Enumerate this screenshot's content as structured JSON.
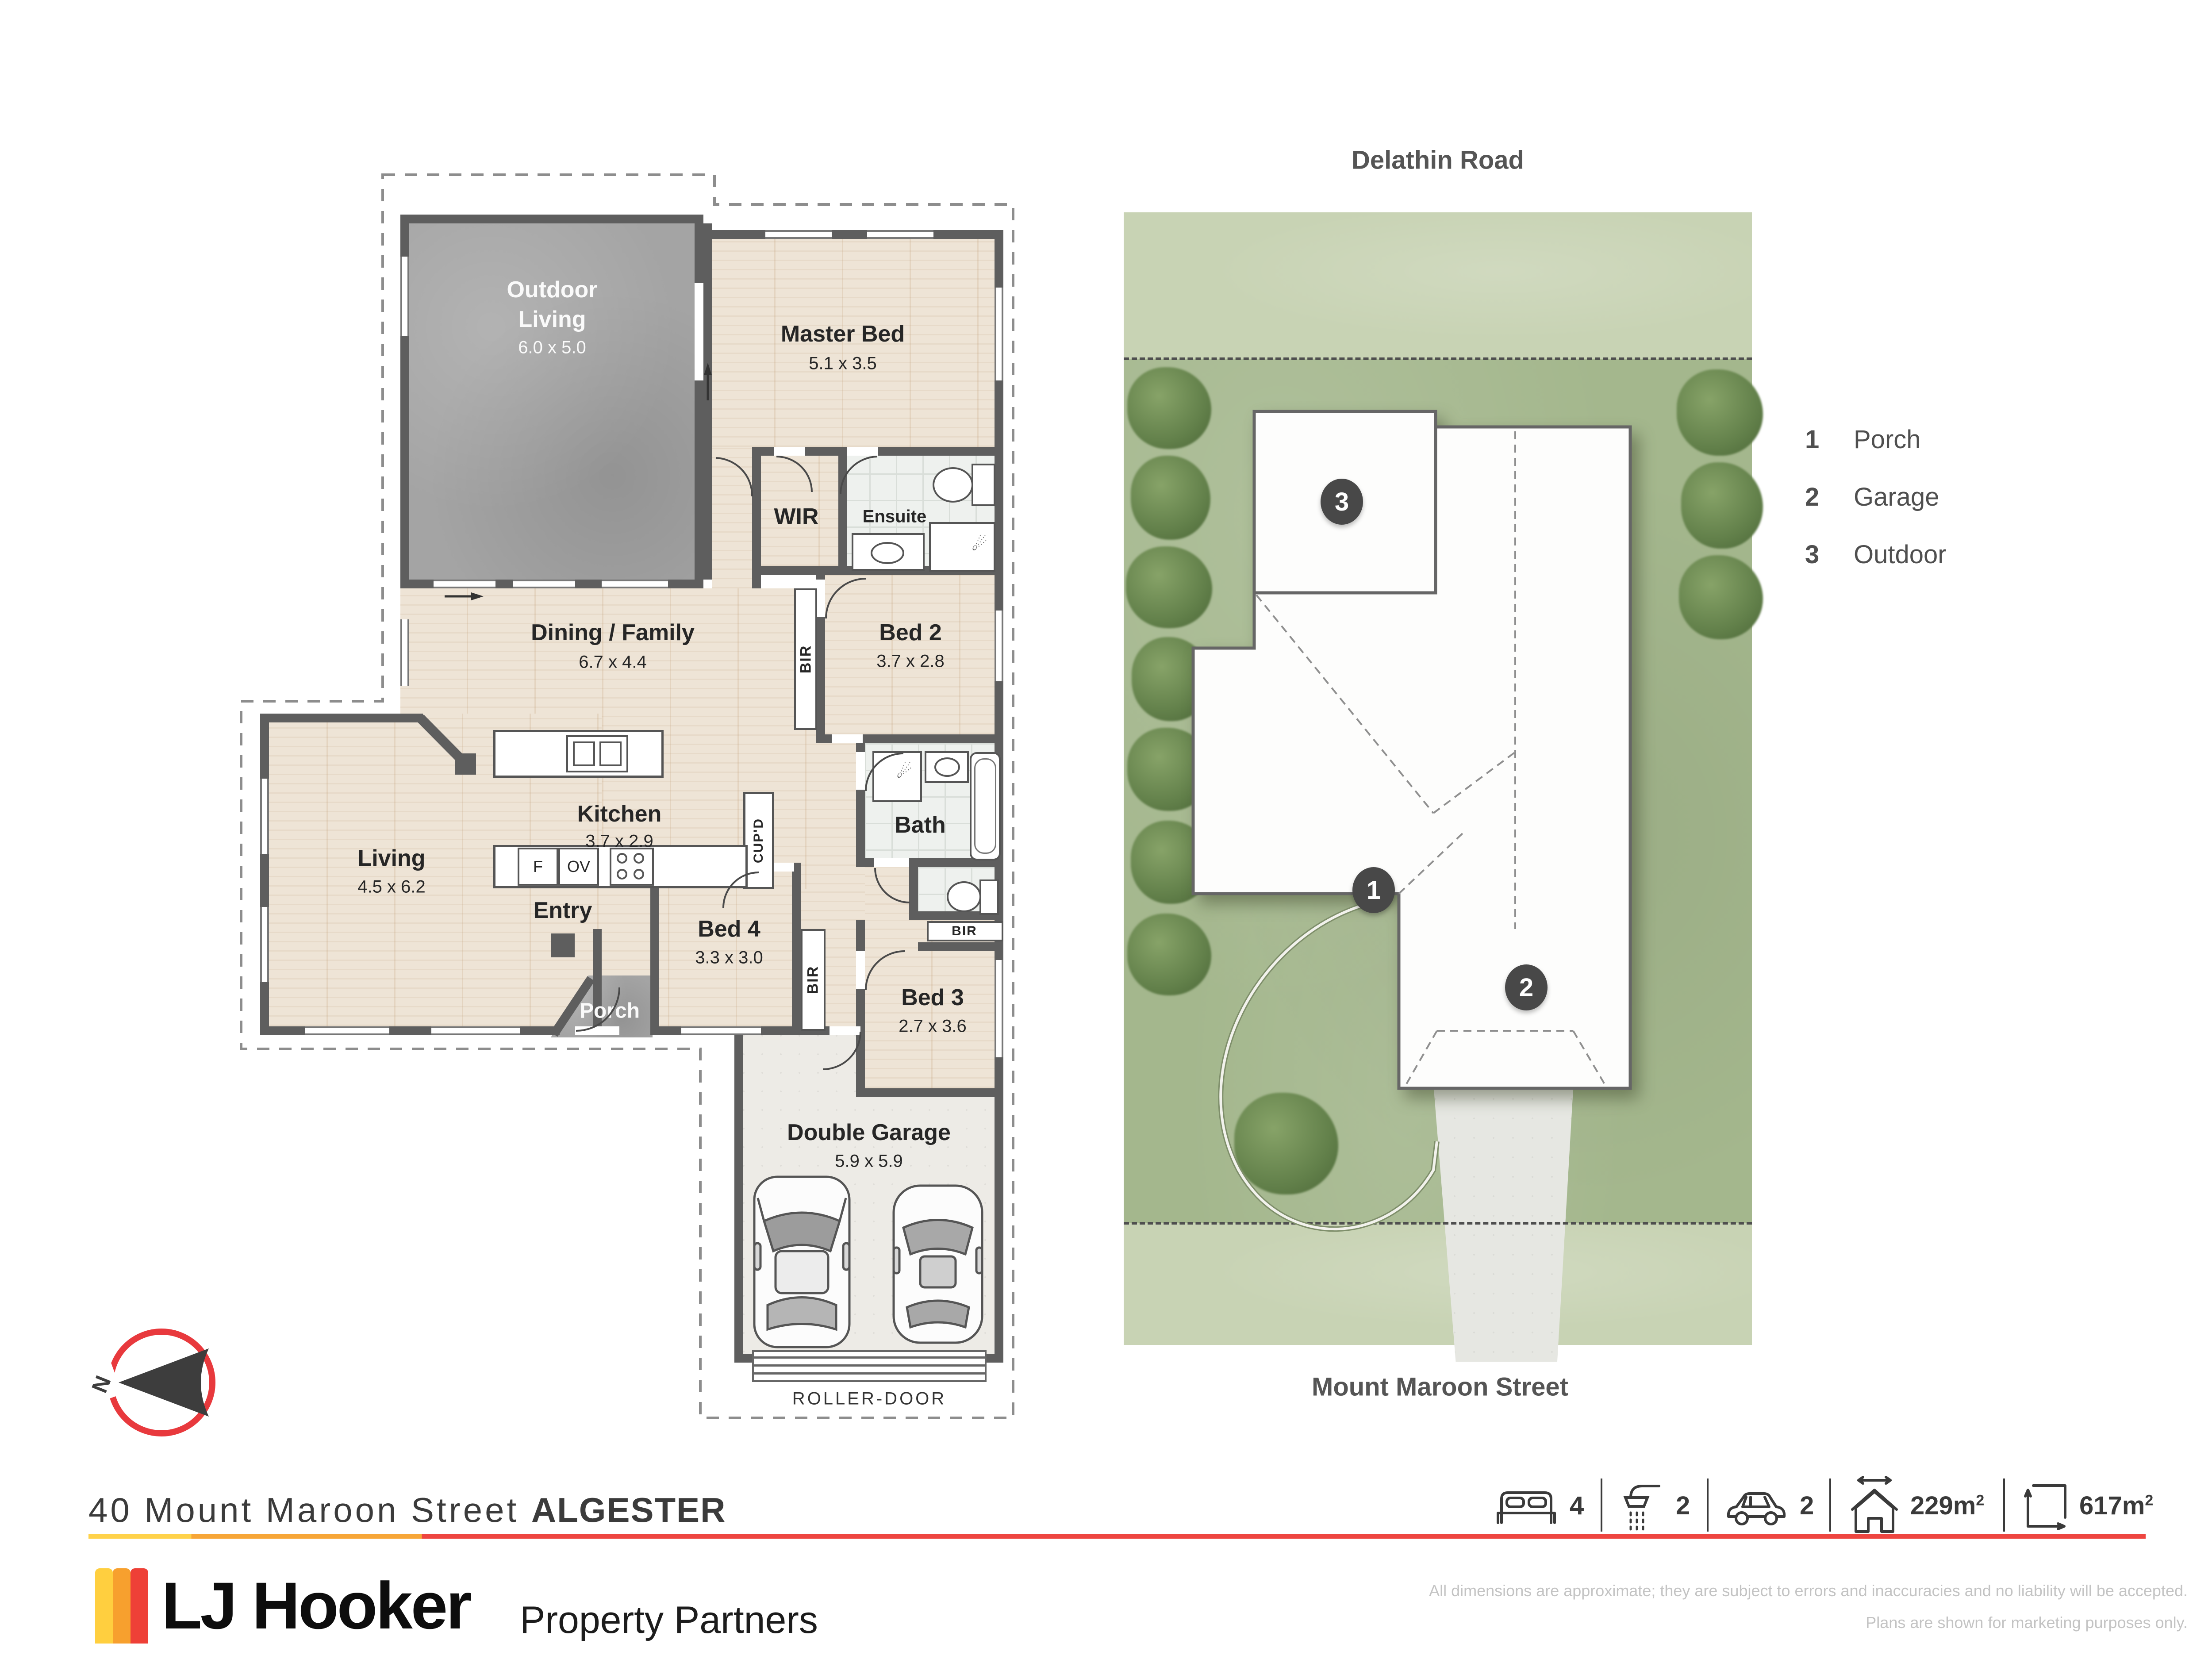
{
  "floorplan": {
    "outdoor": {
      "name1": "Outdoor",
      "name2": "Living",
      "dims": "6.0 x 5.0"
    },
    "master": {
      "name": "Master Bed",
      "dims": "5.1 x 3.5"
    },
    "wir": {
      "name": "WIR"
    },
    "ensuite": {
      "name": "Ensuite"
    },
    "dining": {
      "name": "Dining / Family",
      "dims": "6.7 x 4.4"
    },
    "bed2": {
      "name": "Bed 2",
      "dims": "3.7 x 2.8"
    },
    "kitchen": {
      "name": "Kitchen",
      "dims": "3.7 x 2.9"
    },
    "bath": {
      "name": "Bath"
    },
    "living": {
      "name": "Living",
      "dims": "4.5 x 6.2"
    },
    "entry": {
      "name": "Entry"
    },
    "porch": {
      "name": "Porch"
    },
    "bed4": {
      "name": "Bed 4",
      "dims": "3.3 x 3.0"
    },
    "bed3": {
      "name": "Bed 3",
      "dims": "2.7 x 3.6"
    },
    "garage": {
      "name": "Double Garage",
      "dims": "5.9 x 5.9"
    },
    "bir": "BIR",
    "cupd": "CUP'D",
    "fridge": "F",
    "oven": "OV",
    "roller": "ROLLER-DOOR"
  },
  "siteplan": {
    "road_top": "Delathin Road",
    "road_bottom": "Mount Maroon Street",
    "residence_line1": "Single Storey",
    "residence_line2": "Residence",
    "marker1": "1",
    "marker2": "2",
    "marker3": "3"
  },
  "legend": {
    "items": [
      {
        "num": "1",
        "label": "Porch"
      },
      {
        "num": "2",
        "label": "Garage"
      },
      {
        "num": "3",
        "label": "Outdoor"
      }
    ]
  },
  "compass": {
    "north": "N"
  },
  "footer": {
    "address_street": "40 Mount Maroon Street",
    "address_suburb": "ALGESTER",
    "stats": {
      "beds": {
        "value": "4"
      },
      "baths": {
        "value": "2"
      },
      "cars": {
        "value": "2"
      },
      "house_area": {
        "value": "229m",
        "sup": "2"
      },
      "land_area": {
        "value": "617m",
        "sup": "2"
      }
    },
    "brand": "LJ Hooker",
    "brand_sub": "Property Partners",
    "disclaimer_line1": "All dimensions are approximate; they are subject to errors and inaccuracies and no liability will be accepted.",
    "disclaimer_line2": "Plans are shown for marketing purposes only."
  },
  "colors": {
    "brand_yellow": "#FFCF3F",
    "brand_orange": "#F7A02E",
    "brand_red": "#EE4037",
    "wall": "#5e5e5e"
  }
}
